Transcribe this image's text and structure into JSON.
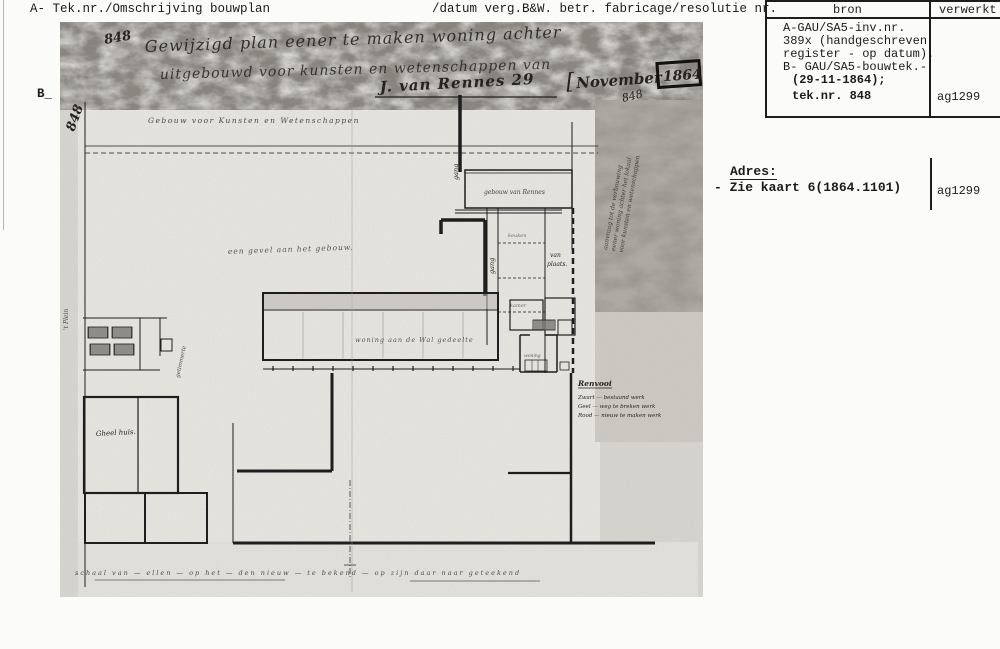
{
  "colors": {
    "ink": "#1b1b1b",
    "hand_ink": "#26231e",
    "photo_base": "#dad8d2",
    "photo_paper": "#eae8e3",
    "band_dark": "#8a8680",
    "band_right": "#b0ada6"
  },
  "header": {
    "left": "A- Tek.nr./Omschrijving bouwplan",
    "right": "/datum verg.B&W. betr. fabricage/resolutie nr.",
    "b_label": "B_"
  },
  "bron_table": {
    "col1_header": "bron",
    "col2_header": "verwerkt",
    "lines": [
      "A-GAU/SA5-inv.nr.",
      "389x (handgeschreven",
      "register - op datum).",
      "B- GAU/SA5-bouwtek.-"
    ],
    "bold_lines": [
      "(29-11-1864);",
      "tek.nr. 848"
    ],
    "verwerkt_value": "ag1299"
  },
  "adres": {
    "label": "Adres:",
    "value": "- Zie kaart 6(1864.1101)",
    "verwerkt_value": "ag1299"
  },
  "drawing": {
    "number_left": "848",
    "number_title": "848",
    "number_stamp": "848",
    "title_line1": "Gewijzigd plan eener te maken woning achter",
    "title_line2": "uitgebouwd voor kunsten en wetenschappen van",
    "signature": "J. van Rennes  29",
    "stamp_bracket": "[",
    "stamp_month": "November",
    "stamp_year": "1864",
    "caption_top": "Gebouw voor Kunsten en Wetenschappen",
    "note_middle": "een gevel aan het gebouw.",
    "margin_note": "'t Plein",
    "label_gang1": "gang",
    "label_gang2": "gang",
    "label_room_top": "gebouw van Rennes",
    "label_keuken": "keuken",
    "label_kamer": "kamer",
    "label_plaats_1": "van",
    "label_plaats_2": "plaats.",
    "label_outbuilding": "getimmerte",
    "label_gheel": "Gheel huis.",
    "label_central": "woning aan de Wal gedeelte",
    "label_woning_small": "woning",
    "legend_title": "Renvooi",
    "legend_items": [
      "Zwart — bestaand werk",
      "Geel — weg te breken werk",
      "Rood — nieuw te maken werk"
    ],
    "side_note_lines": [
      "aanvraag tot de verbouwing",
      "eener woning achter het lokaal",
      "voor kunsten en wetenschappen"
    ],
    "bottom_note": "schaal van — ellen — op het — den nieuw — te bekend — op zijn daar naar geteekend"
  }
}
